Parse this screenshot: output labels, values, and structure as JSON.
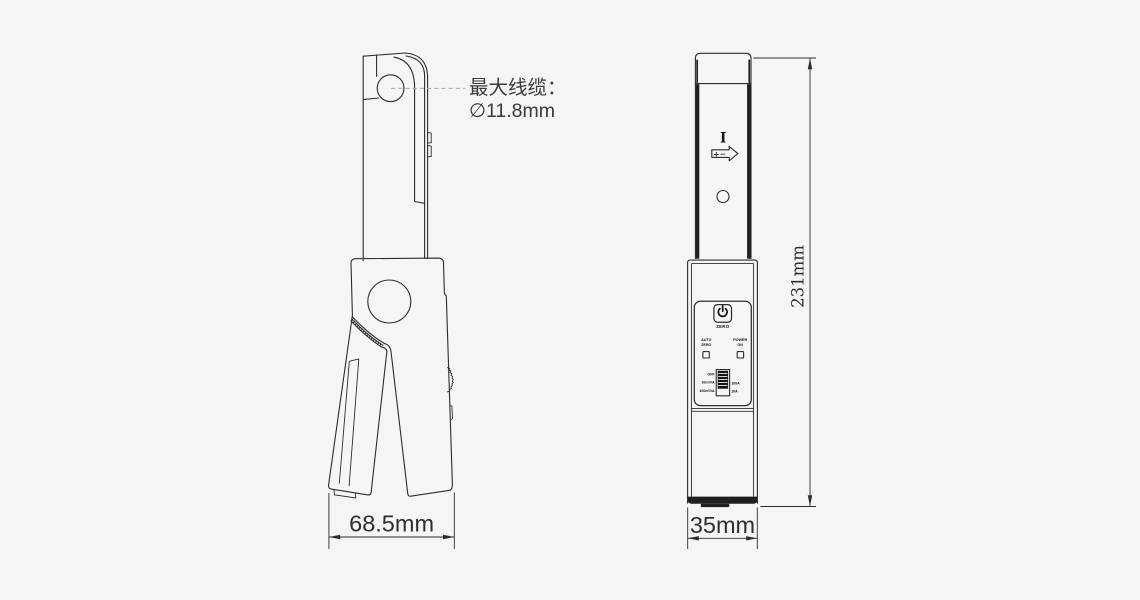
{
  "annotation": {
    "line1": "最大线缆：",
    "line2": "∅11.8mm"
  },
  "dimensions": {
    "side_view_width": "68.5mm",
    "front_view_width": "35mm",
    "front_view_height": "231mm"
  },
  "front_view": {
    "jaw_markings": {
      "current_mark": "I",
      "polarity_mark": "+−"
    },
    "panel": {
      "zero_button_label": "ZERO",
      "auto_zero_led": {
        "line1": "AUTO",
        "line2": "ZERO"
      },
      "power_on_led": {
        "line1": "POWER",
        "line2": "ON"
      },
      "range_switch": {
        "off": "OFF",
        "sensitivity_high": "10mV/A",
        "sensitivity_low": "100mV/A",
        "range_high": "100A",
        "range_low": "10A"
      }
    }
  },
  "colors": {
    "background": "#f5f5f5",
    "line": "#2d2d2d",
    "text": "#2e2e2e",
    "dark_fill": "#1f1f1f"
  }
}
